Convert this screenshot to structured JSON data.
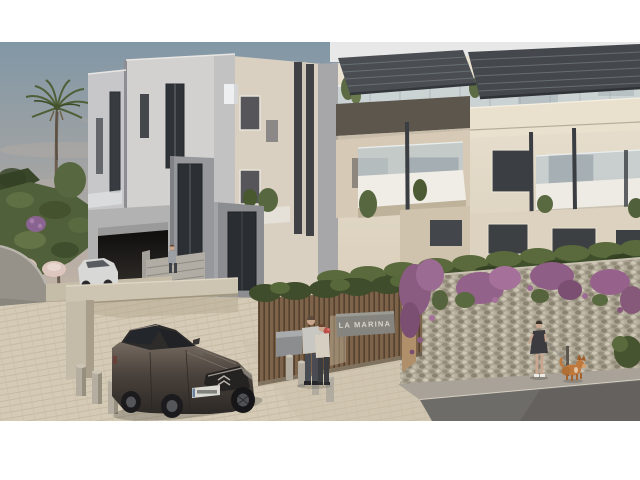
{
  "image": {
    "kind": "architectural exterior render",
    "caption": "Modern apartment complex at dusk with entrance driveway"
  },
  "scene": {
    "sign": {
      "text": "LA MARINA"
    },
    "elements": [
      {
        "name": "sky",
        "color": "#8297a6"
      },
      {
        "name": "palm-tree",
        "color": "#4f6038"
      },
      {
        "name": "garden-hillside",
        "color": "#50603a"
      },
      {
        "name": "pampas-bushes",
        "color": "#d9bfb6"
      },
      {
        "name": "left-tower-building",
        "color": "#cfcecd"
      },
      {
        "name": "garage-opening",
        "color": "#262422"
      },
      {
        "name": "white-parked-car",
        "color": "#d8d8d6"
      },
      {
        "name": "entrance-doors",
        "color": "#2c3034"
      },
      {
        "name": "stairs-person"
      },
      {
        "name": "timber-slat-fence",
        "color": "#7c6349"
      },
      {
        "name": "entrance-sign",
        "text": "LA MARINA"
      },
      {
        "name": "right-apartment-building",
        "color": "#e6decd"
      },
      {
        "name": "pergolas",
        "color": "#44484c"
      },
      {
        "name": "glass-balconies",
        "color": "#c6d0d3"
      },
      {
        "name": "hedge",
        "color": "#41502c"
      },
      {
        "name": "gabion-stone-wall",
        "color": "#ada694"
      },
      {
        "name": "bougainvillea",
        "color": "#96628c"
      },
      {
        "name": "embracing-couple"
      },
      {
        "name": "woman-walking-dog"
      },
      {
        "name": "dog",
        "color": "#c0793c"
      },
      {
        "name": "dark-hatchback-car",
        "color": "#463f3a"
      },
      {
        "name": "license-plate",
        "color": "#dadad2"
      },
      {
        "name": "bollards",
        "color": "#b5aea0"
      },
      {
        "name": "paver-driveway",
        "color": "#d4cab6"
      },
      {
        "name": "asphalt-road",
        "color": "#6e6c69"
      }
    ]
  }
}
